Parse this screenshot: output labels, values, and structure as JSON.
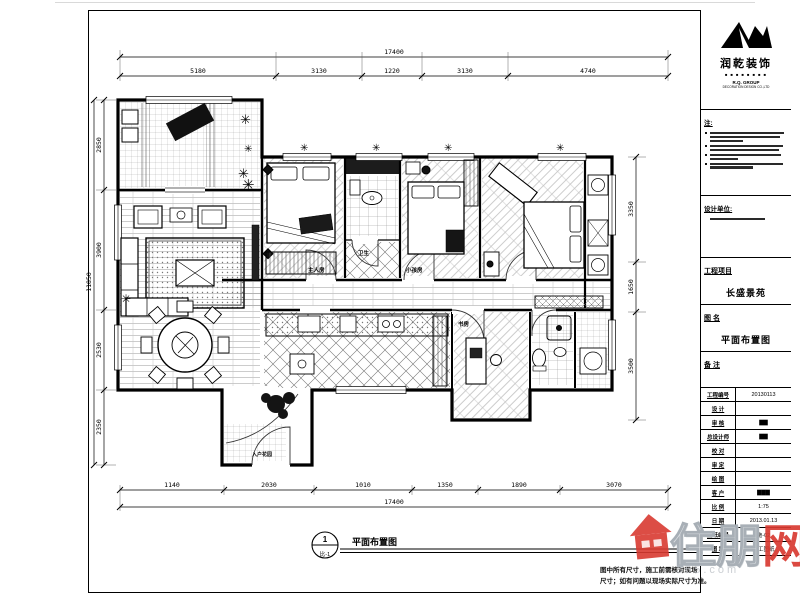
{
  "logo": {
    "company": "润乾装饰",
    "squares": "■ ■ ■ ■ ■ ■ ■ ■",
    "line1": "R.Q. GROUP",
    "line2": "DECORATION DESIGN CO.,LTD"
  },
  "titleblock": {
    "notes_label": "注:",
    "design_unit_label": "设计单位:",
    "project_label": "工程项目",
    "project_value": "长盛景苑",
    "drawing_label": "图 名",
    "drawing_value": "平面布置图",
    "remark_label": "备 注",
    "rows": [
      {
        "label": "工程编号",
        "value": "20130113"
      },
      {
        "label": "设 计",
        "value": ""
      },
      {
        "label": "审 核",
        "value": "▇▇"
      },
      {
        "label": "总设计师",
        "value": "▇▇"
      },
      {
        "label": "校 对",
        "value": ""
      },
      {
        "label": "审 定",
        "value": ""
      },
      {
        "label": "绘 图",
        "value": ""
      },
      {
        "label": "客 户",
        "value": "▇▇▇"
      },
      {
        "label": "比 例",
        "value": "1:75"
      },
      {
        "label": "日 期",
        "value": "2013.01.13"
      },
      {
        "label": "图纸编号",
        "value": "施-02"
      },
      {
        "label": "图 章",
        "value": "施工图纸"
      }
    ]
  },
  "plan": {
    "door_labels": {
      "bed1": "主人房",
      "bed2": "小孩房",
      "bath": "卫生",
      "study": "书房",
      "entry": "入户花园"
    }
  },
  "dims": {
    "top_total": "17400",
    "top_segments": [
      "5180",
      "3130",
      "1220",
      "3130",
      "4740"
    ],
    "left_total": "11850",
    "left_segments": [
      "2850",
      "3900",
      "2530",
      "2350"
    ],
    "right_segments": [
      "3350",
      "1650",
      "3500"
    ],
    "bottom_segments": [
      "1140",
      "2030",
      "1010",
      "1350",
      "1890",
      "3070"
    ],
    "bottom_total": "17400"
  },
  "footer": {
    "marker_number": "1",
    "marker_code": "比-1",
    "drawing_title": "平面布置图",
    "note_line1": "图中所有尺寸，施工前需核对现场",
    "note_line2": "尺寸；如有问题以现场实际尺寸为准。"
  },
  "watermark": {
    "brand_first": "住朋",
    "brand_last": "网",
    "url_fragment": "365.com"
  }
}
